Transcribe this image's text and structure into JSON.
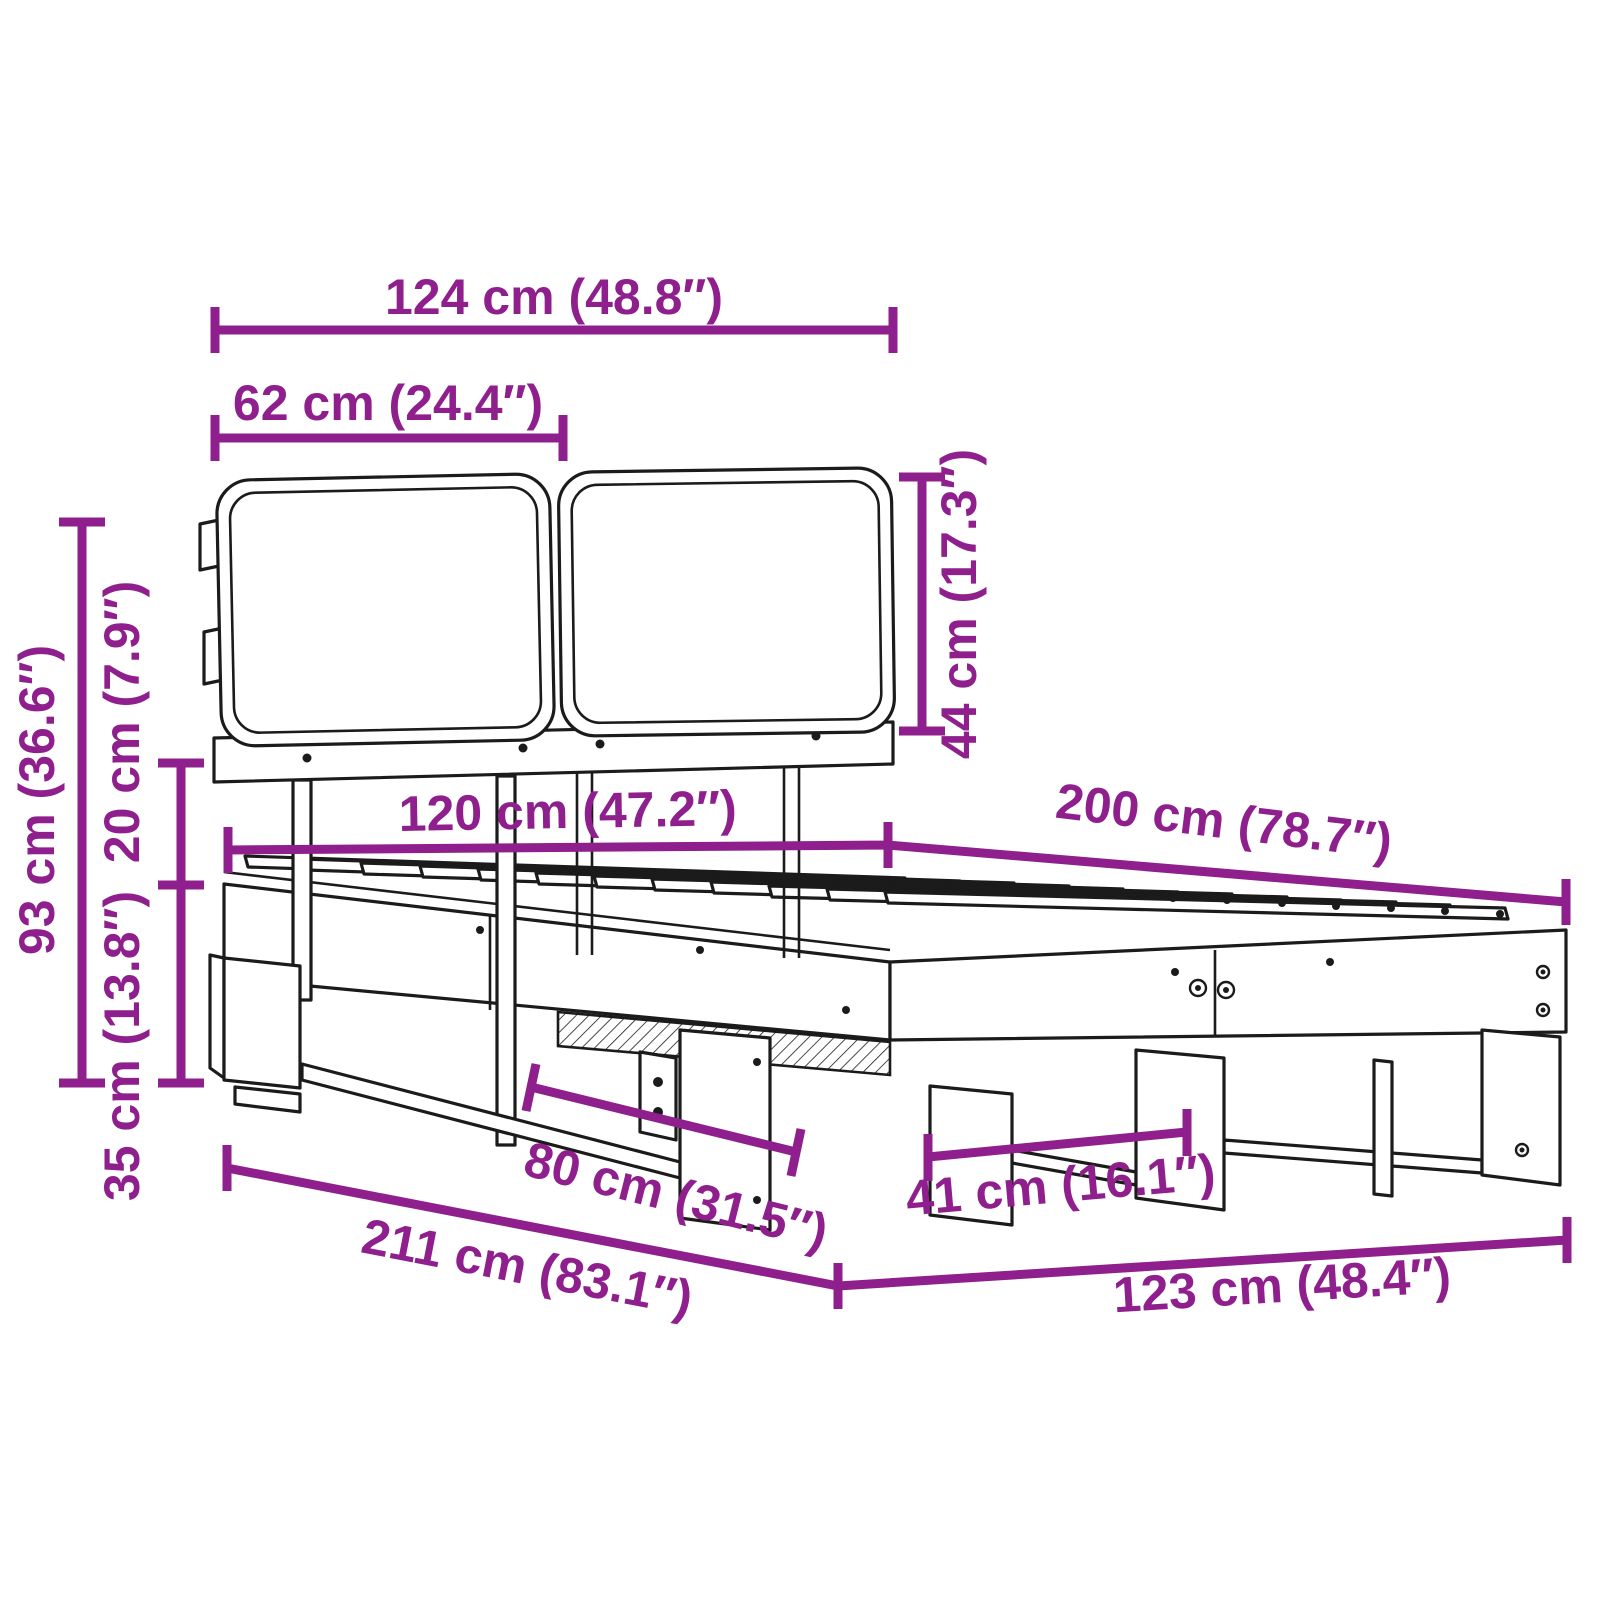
{
  "diagram": {
    "subject": "bed-frame-with-slatted-base-and-cushion-headboard",
    "accent_color": "#8e1f8c",
    "line_color": "#1b1b1b",
    "unit_primary": "cm",
    "unit_secondary": "inches",
    "dimensions": [
      {
        "id": "headboard-total-width",
        "cm": 124,
        "in": 48.8,
        "label": "124 cm (48.8″)"
      },
      {
        "id": "cushion-width",
        "cm": 62,
        "in": 24.4,
        "label": "62 cm (24.4″)"
      },
      {
        "id": "cushion-height",
        "cm": 44,
        "in": 17.3,
        "label": "44 cm (17.3″)"
      },
      {
        "id": "total-height",
        "cm": 93,
        "in": 36.6,
        "label": "93 cm (36.6″)"
      },
      {
        "id": "frame-height",
        "cm": 20,
        "in": 7.9,
        "label": "20 cm (7.9″)"
      },
      {
        "id": "underbed-clearance",
        "cm": 35,
        "in": 13.8,
        "label": "35 cm (13.8″)"
      },
      {
        "id": "bed-width",
        "cm": 120,
        "in": 47.2,
        "label": "120 cm (47.2″)"
      },
      {
        "id": "bed-length",
        "cm": 200,
        "in": 78.7,
        "label": "200 cm (78.7″)"
      },
      {
        "id": "leg-spacing-side",
        "cm": 80,
        "in": 31.5,
        "label": "80 cm (31.5″)"
      },
      {
        "id": "leg-spacing-foot",
        "cm": 41,
        "in": 16.1,
        "label": "41 cm (16.1″)"
      },
      {
        "id": "total-length",
        "cm": 211,
        "in": 83.1,
        "label": "211 cm (83.1″)"
      },
      {
        "id": "total-width",
        "cm": 123,
        "in": 48.4,
        "label": "123 cm (48.4″)"
      }
    ]
  }
}
